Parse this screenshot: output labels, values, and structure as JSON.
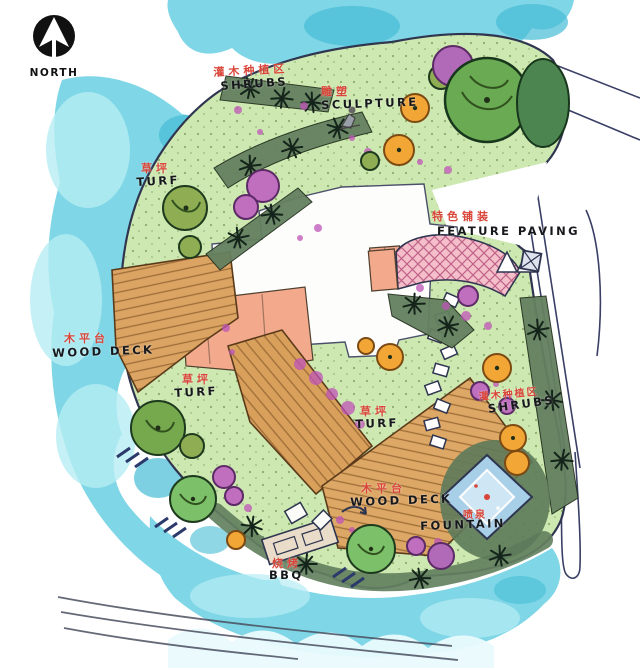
{
  "compass": {
    "label": "NORTH"
  },
  "labels": {
    "shrubs_top": {
      "zh": "灌木种植区",
      "en": "SHRUBS"
    },
    "sculpture": {
      "zh": "雕塑",
      "en": "SCULPTURE"
    },
    "turf_upper": {
      "zh": "草坪",
      "en": "TURF"
    },
    "feature_paving": {
      "zh": "特色铺装",
      "en": "FEATURE PAVING"
    },
    "wood_deck_left": {
      "zh": "木平台",
      "en": "WOOD DECK"
    },
    "turf_mid": {
      "zh": "草坪",
      "en": "TURF"
    },
    "turf_center": {
      "zh": "草坪",
      "en": "TURF"
    },
    "shrubs_right": {
      "zh": "灌木种植区",
      "en": "SHRUBS"
    },
    "wood_deck_bottom": {
      "zh": "木平台",
      "en": "WOOD DECK"
    },
    "fountain": {
      "zh": "喷泉",
      "en": "FOUNTAIN"
    },
    "bbq": {
      "zh": "烧烤",
      "en": "BBQ"
    }
  },
  "colors": {
    "water": "#7fd6e6",
    "water_dark": "#46bcd6",
    "water_light": "#b7edf4",
    "lawn": "#cde8b0",
    "deck_wood": "#dba462",
    "terrace": "#f2a98c",
    "paving_pink": "#f4bfca",
    "shrub_band": "#64805f",
    "tree_green": "#69aa52",
    "tree_olive": "#8fae53",
    "tree_orange": "#f2a636",
    "tree_purple": "#c06fbe",
    "label_red": "#d94538",
    "ink": "#2f3550"
  }
}
